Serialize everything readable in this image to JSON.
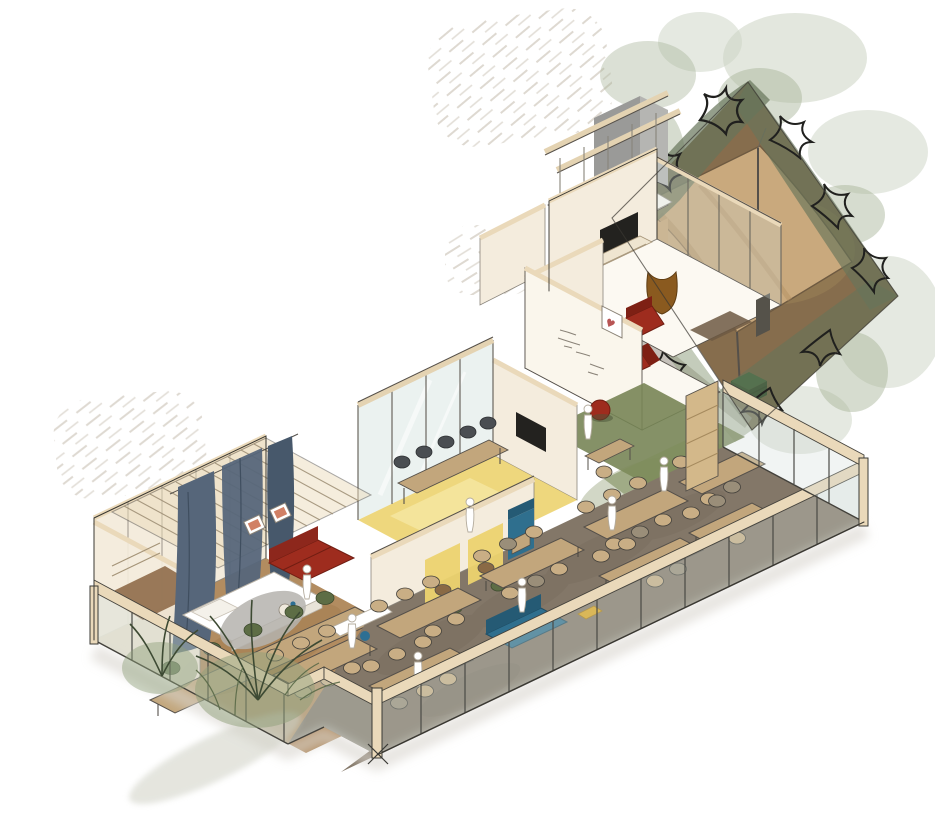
{
  "scene": {
    "kind": "hand-drawn isometric cutaway interior sketch",
    "rooms": [
      "bedroom-suite-wing",
      "planted-facade",
      "dining-hall",
      "cafe-booth-nook",
      "meeting-room",
      "reading-lounge",
      "corridor-desk",
      "sitting-room",
      "tv-garden-room",
      "stair-core",
      "garden-terrace",
      "canopy-pavilion"
    ],
    "furniture_counts": {
      "dining_tables": 8,
      "dining_chairs": 34,
      "meeting_chairs": 5,
      "green_chairs": 5,
      "figures": 8
    }
  },
  "palette": {
    "paper": "#ffffff",
    "ink": "#3a3832",
    "pencil": "#d8d2c9",
    "wall_face": "#f4ecdd",
    "wall_cut": "#ead9ba",
    "wood_beam": "#e4d3b2",
    "table_tan": "#c2a67c",
    "floor_wing": "#b28c60",
    "floor_hall": "#837768",
    "floor_yellow": "#ecd36f",
    "floor_green": "#7f8d5c",
    "glass_tint": "#cfdcd6",
    "glass_blue": "#dbe7e3",
    "curtain": "#56667a",
    "curtain_dark": "#47586b",
    "red_accent": "#9e2c1e",
    "maroon_wall": "#7b4034",
    "grey_wall": "#9a9a98",
    "garden_ground": "#8c7252",
    "canopy": "#c9a97d",
    "canopy_shade": "#b18f62",
    "hedge_green": "#67755a",
    "foliage_soft": "#ccd4c3",
    "foliage_mid": "#a5b295",
    "crate_green": "#2c5531",
    "sofa_blue": "#2f6f8e",
    "chair_tan": "#c9ae85",
    "chair_dim": "#9a8e79",
    "chair_dark": "#4a4e52",
    "chair_green": "#5d6d45",
    "yellow_accent": "#dfa61c",
    "rug_grey": "#b5b3ae",
    "rug_brown": "#6d5943",
    "brown_leather": "#8a5a1f",
    "tv_black": "#23221f",
    "shadow": "#d8d4cd",
    "art_orange": "#c96a4a",
    "heart_red": "#b85555",
    "path_grey": "#b7b2a9",
    "stool_blue": "#2d6f93",
    "heart_glyph": "♥"
  }
}
